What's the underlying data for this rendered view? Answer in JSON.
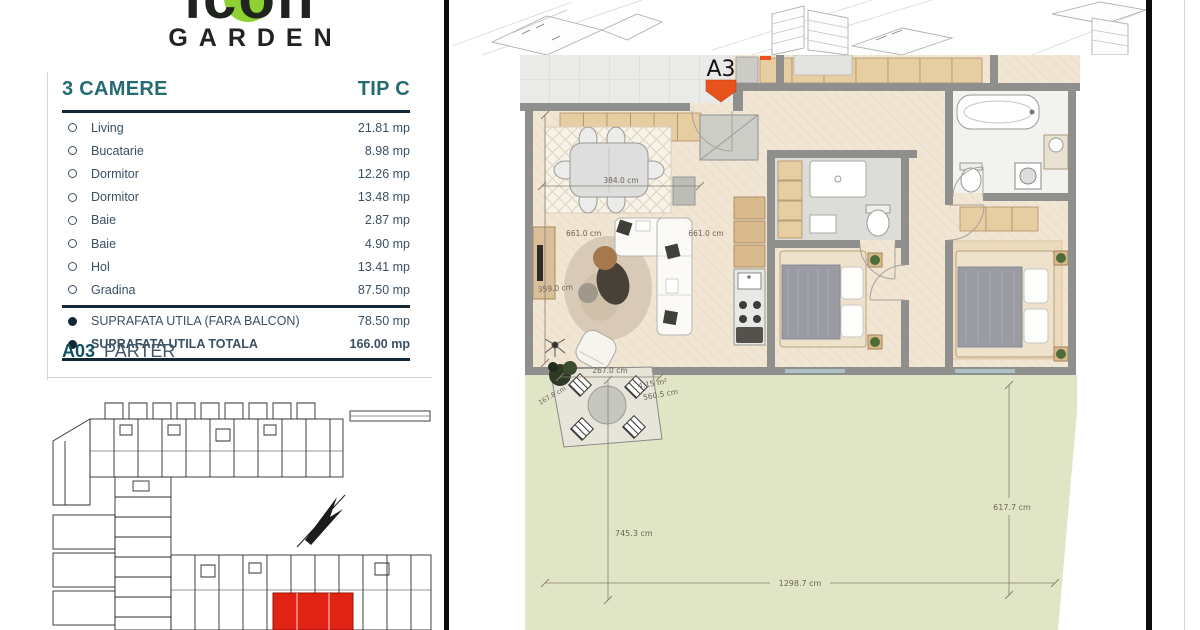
{
  "logo": {
    "brand": "icon",
    "subtitle": "GARDEN",
    "green": "#8ed133"
  },
  "spec_table": {
    "title": "3 CAMERE",
    "type_label": "TIP C",
    "accent_color": "#266b74",
    "rooms": [
      {
        "label": "Living",
        "value": "21.81 mp"
      },
      {
        "label": "Bucatarie",
        "value": "8.98 mp"
      },
      {
        "label": "Dormitor",
        "value": "12.26 mp"
      },
      {
        "label": "Dormitor",
        "value": "13.48 mp"
      },
      {
        "label": "Baie",
        "value": "2.87 mp"
      },
      {
        "label": "Baie",
        "value": "4.90 mp"
      },
      {
        "label": "Hol",
        "value": "13.41 mp"
      },
      {
        "label": "Gradina",
        "value": "87.50 mp"
      }
    ],
    "totals": [
      {
        "label": "SUPRAFATA UTILA (FARA BALCON)",
        "value": "78.50 mp"
      },
      {
        "label": "SUPRAFATA UTILA TOTALA",
        "value": "166.00 mp"
      }
    ]
  },
  "unit": {
    "code": "A03",
    "level": "PARTER"
  },
  "floor_plan": {
    "marker_label": "A3",
    "marker_color": "#e8521d",
    "dims": {
      "dining_width": "384.0 cm",
      "living_depth": "661.0 cm",
      "kitchen_depth": "661.0 cm",
      "living_width": "359.0 cm",
      "terrace_width": "267.0 cm",
      "terrace_area": "4,15 m²",
      "terrace_diagonal": "560.5 cm",
      "terrace_side": "167.8 cm",
      "garden_height_left": "745.3 cm",
      "garden_height_right": "617.7 cm",
      "garden_width": "1298.7 cm"
    },
    "colors": {
      "floor": "#f1e5d3",
      "wall": "#8f8f8d",
      "tile": "#e6cda2",
      "garden": "#e0e5c6",
      "terrace": "#eaeae8"
    }
  },
  "site_plan": {
    "highlight_color": "#e02314"
  }
}
